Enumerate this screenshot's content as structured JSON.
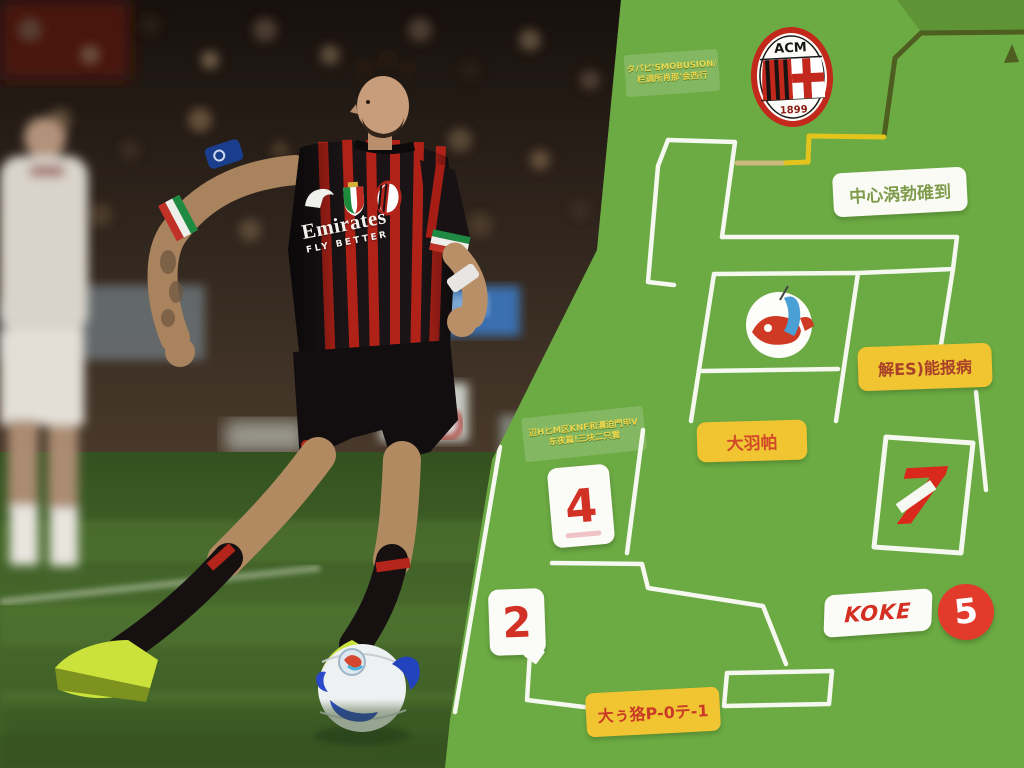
{
  "photo": {
    "sponsor": "Emirates",
    "sponsor_sub": "FLY BETTER",
    "icons": [
      "puma-logo",
      "scudetto-patch",
      "ac-milan-crest-small",
      "serie-a-patch",
      "tricolor-armband",
      "wrist-tape",
      "match-ball",
      "volt-boots",
      "blurred-opponent",
      "stadium-crowd"
    ]
  },
  "panel": {
    "milan_crest": {
      "top": "ACM",
      "year": "1899"
    },
    "koln_badge_icon": "red-blue-club-crest",
    "note_top_left": {
      "line1": "タパピ'SMOBUSION/",
      "line2": "栏调所肖那'会西行"
    },
    "label_center": "中心涡勃碓到",
    "label_right": "解ES)能报病",
    "label_mid": "大羽帕",
    "note_mid_left": {
      "line1": "辺H匕M区KNF和濃迫門甲V",
      "line2": "东夜篇!三块二只雲"
    },
    "card_4": "4",
    "card_2": "2",
    "number_7": "7",
    "player_label": "KOKE",
    "number_5": "5",
    "label_bottom": "大ぅ狢P-0テ-1"
  },
  "colors": {
    "panel_green": "#6CAA43",
    "line_white": "#F4F8EE",
    "line_olive": "#4E5D20",
    "line_yellow": "#E3C41D",
    "label_yellow": "#F1C431",
    "number_red": "#D8291C",
    "milan_red": "#C3281C",
    "badge_blue": "#4A9FD4",
    "boot_volt": "#CBE23C"
  }
}
